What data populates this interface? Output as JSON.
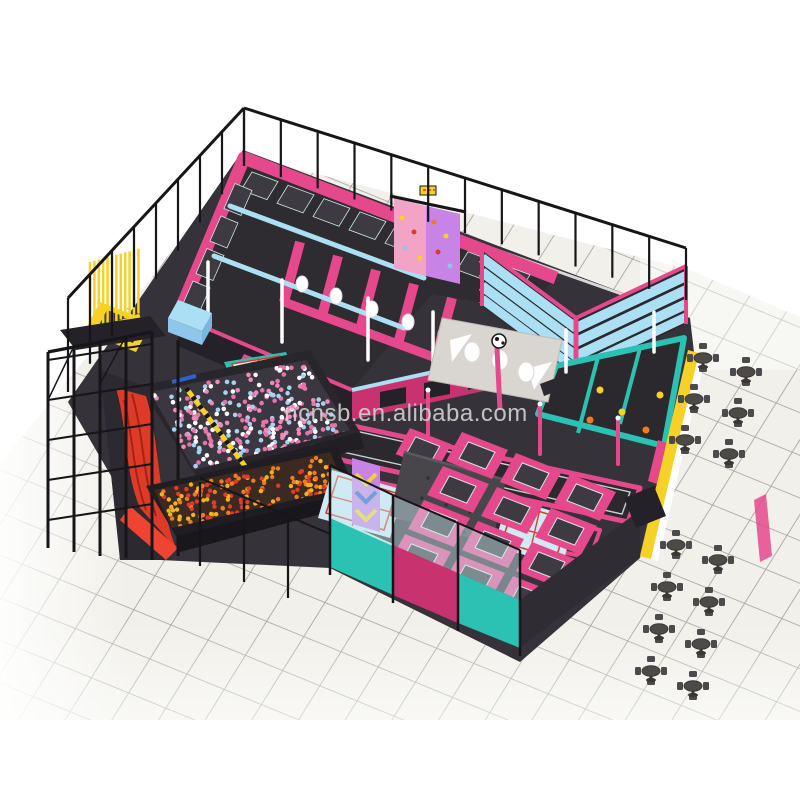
{
  "meta": {
    "description": "3D isometric product render of an indoor trampoline park on a white tiled floor",
    "canvas_px": "800x800",
    "background": "#ffffff"
  },
  "watermark": {
    "text": "ncnsb.en.alibaba.com"
  },
  "palette": {
    "bg": "#ffffff",
    "tile": "#f1f0ea",
    "tileLine": "#a8a8a2",
    "floor": "#363239",
    "floorDark": "#2b282e",
    "pink": "#e5498c",
    "pinkDark": "#c8336f",
    "pinkPanel": "#f2a3c6",
    "purple": "#c783e6",
    "cyan": "#abe0f4",
    "blue": "#8fc7ea",
    "teal": "#2bc1b3",
    "yellow": "#f6d228",
    "red": "#df3a28",
    "redDark": "#a32417",
    "orange": "#f07c22",
    "gray": "#d9d6d1",
    "grayDark": "#4c4a4d",
    "black": "#161518",
    "white": "#ffffff",
    "bed": "#3d3a41",
    "bedTrim": "#cfe9e4",
    "ballPink": "#f08ab8",
    "ballBlue": "#a6d4f0",
    "wm": "#cfcfcf"
  },
  "scene": {
    "cafe_tables": {
      "count": 14,
      "chairs_per_table": 4,
      "positions": [
        [
          703,
          358
        ],
        [
          746,
          372
        ],
        [
          694,
          399
        ],
        [
          738,
          413
        ],
        [
          685,
          440
        ],
        [
          729,
          454
        ],
        [
          676,
          545
        ],
        [
          718,
          560
        ],
        [
          667,
          587
        ],
        [
          709,
          602
        ],
        [
          659,
          629
        ],
        [
          701,
          644
        ],
        [
          651,
          671
        ],
        [
          693,
          686
        ]
      ]
    },
    "ball_pits": [
      {
        "name": "pink-blue-ball-pit",
        "origin": [
          152,
          394
        ],
        "e1": [
          152,
          -32
        ],
        "e2": [
          44,
          74
        ],
        "colors": [
          "#f08ab8",
          "#a6d4f0",
          "#ffffff",
          "#e873a8"
        ],
        "count": 300,
        "radius": 2.3
      },
      {
        "name": "orange-ball-pit",
        "origin": [
          156,
          492
        ],
        "e1": [
          172,
          -38
        ],
        "e2": [
          18,
          38
        ],
        "colors": [
          "#f07c22",
          "#f3b31c",
          "#e03a28"
        ],
        "count": 170,
        "radius": 2.2
      }
    ],
    "fence_segments": [
      {
        "name": "fence-left",
        "x1": 68,
        "y1": 392,
        "x2": 244,
        "y2": 166,
        "h1": 94,
        "h2": 58,
        "posts": 8
      },
      {
        "name": "fence-back",
        "x1": 244,
        "y1": 166,
        "x2": 686,
        "y2": 300,
        "h1": 58,
        "h2": 52,
        "posts": 12
      }
    ]
  }
}
